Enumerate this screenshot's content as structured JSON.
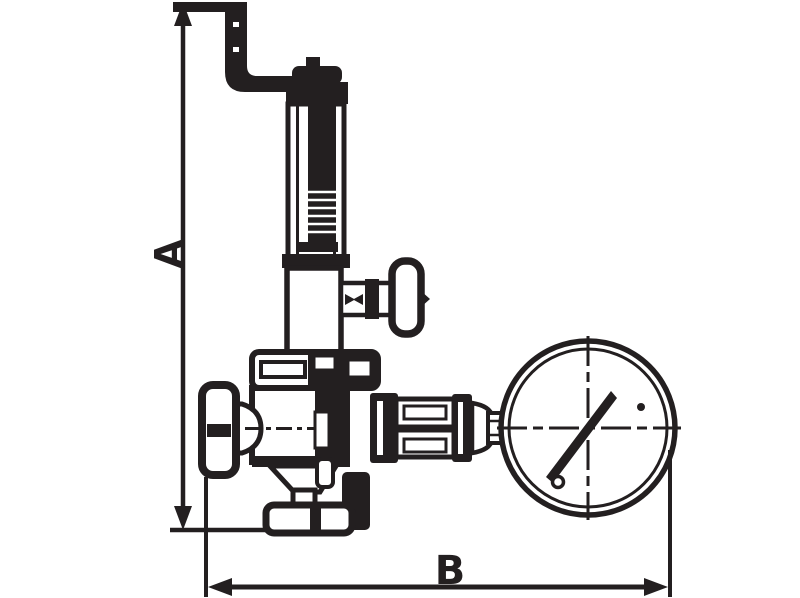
{
  "drawing": {
    "type": "technical-line-drawing",
    "subject": "spring-loaded valve with bent lever handle, side handwheel and pressure gauge (side elevation)",
    "background_color": "#ffffff",
    "line_color": "#231f20",
    "dimension_a": {
      "label": "A",
      "orientation": "vertical"
    },
    "dimension_b": {
      "label": "B",
      "orientation": "horizontal"
    },
    "parts": [
      "bent-lever-handle",
      "adjusting-cap",
      "spring-bonnet",
      "bonnet-locknut",
      "tee-handle",
      "body-top-flange",
      "valve-body",
      "side-handwheel",
      "bottom-outlet-cone",
      "bottom-outlet-flange",
      "gauge-connection-fitting",
      "pressure-gauge",
      "gauge-needle"
    ]
  }
}
